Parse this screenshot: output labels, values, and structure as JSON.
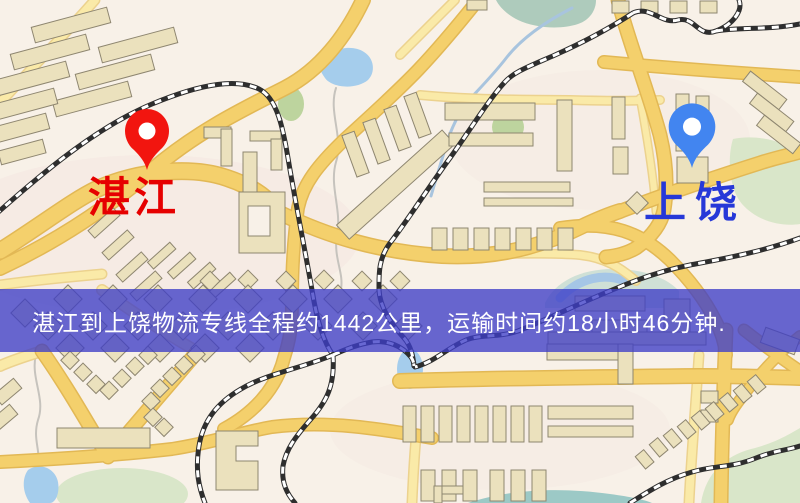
{
  "map": {
    "type": "road-map",
    "origin_marker": {
      "label": "湛江",
      "pin": "red-map-pin"
    },
    "destination_marker": {
      "label": "上饶",
      "pin": "blue-map-pin"
    },
    "banner": {
      "text": "湛江到上饶物流专线全程约1442公里，运输时间约18小时46分钟.",
      "distance_km": 1442,
      "duration_text": "18小时46分钟"
    },
    "palette": {
      "background": "#f8f1e8",
      "road_fill": "#f4d06c",
      "road_casing": "#e2b855",
      "minor_road_fill": "#faeaa8",
      "minor_road_casing": "#ecd28e",
      "building_fill": "#ebe1bd",
      "building_stroke": "#8e8670",
      "park_green": "#bdd49e",
      "park_pale": "#d9e6c9",
      "water_blue": "#a5cdec",
      "railway_dark": "#2e2e2e",
      "origin_pin": "#f2150f",
      "origin_label": "#e60000",
      "dest_pin": "#4285f0",
      "dest_label": "#2638d8",
      "banner_bg": "rgba(62,62,198,0.78)",
      "banner_text": "#ffffff"
    }
  }
}
